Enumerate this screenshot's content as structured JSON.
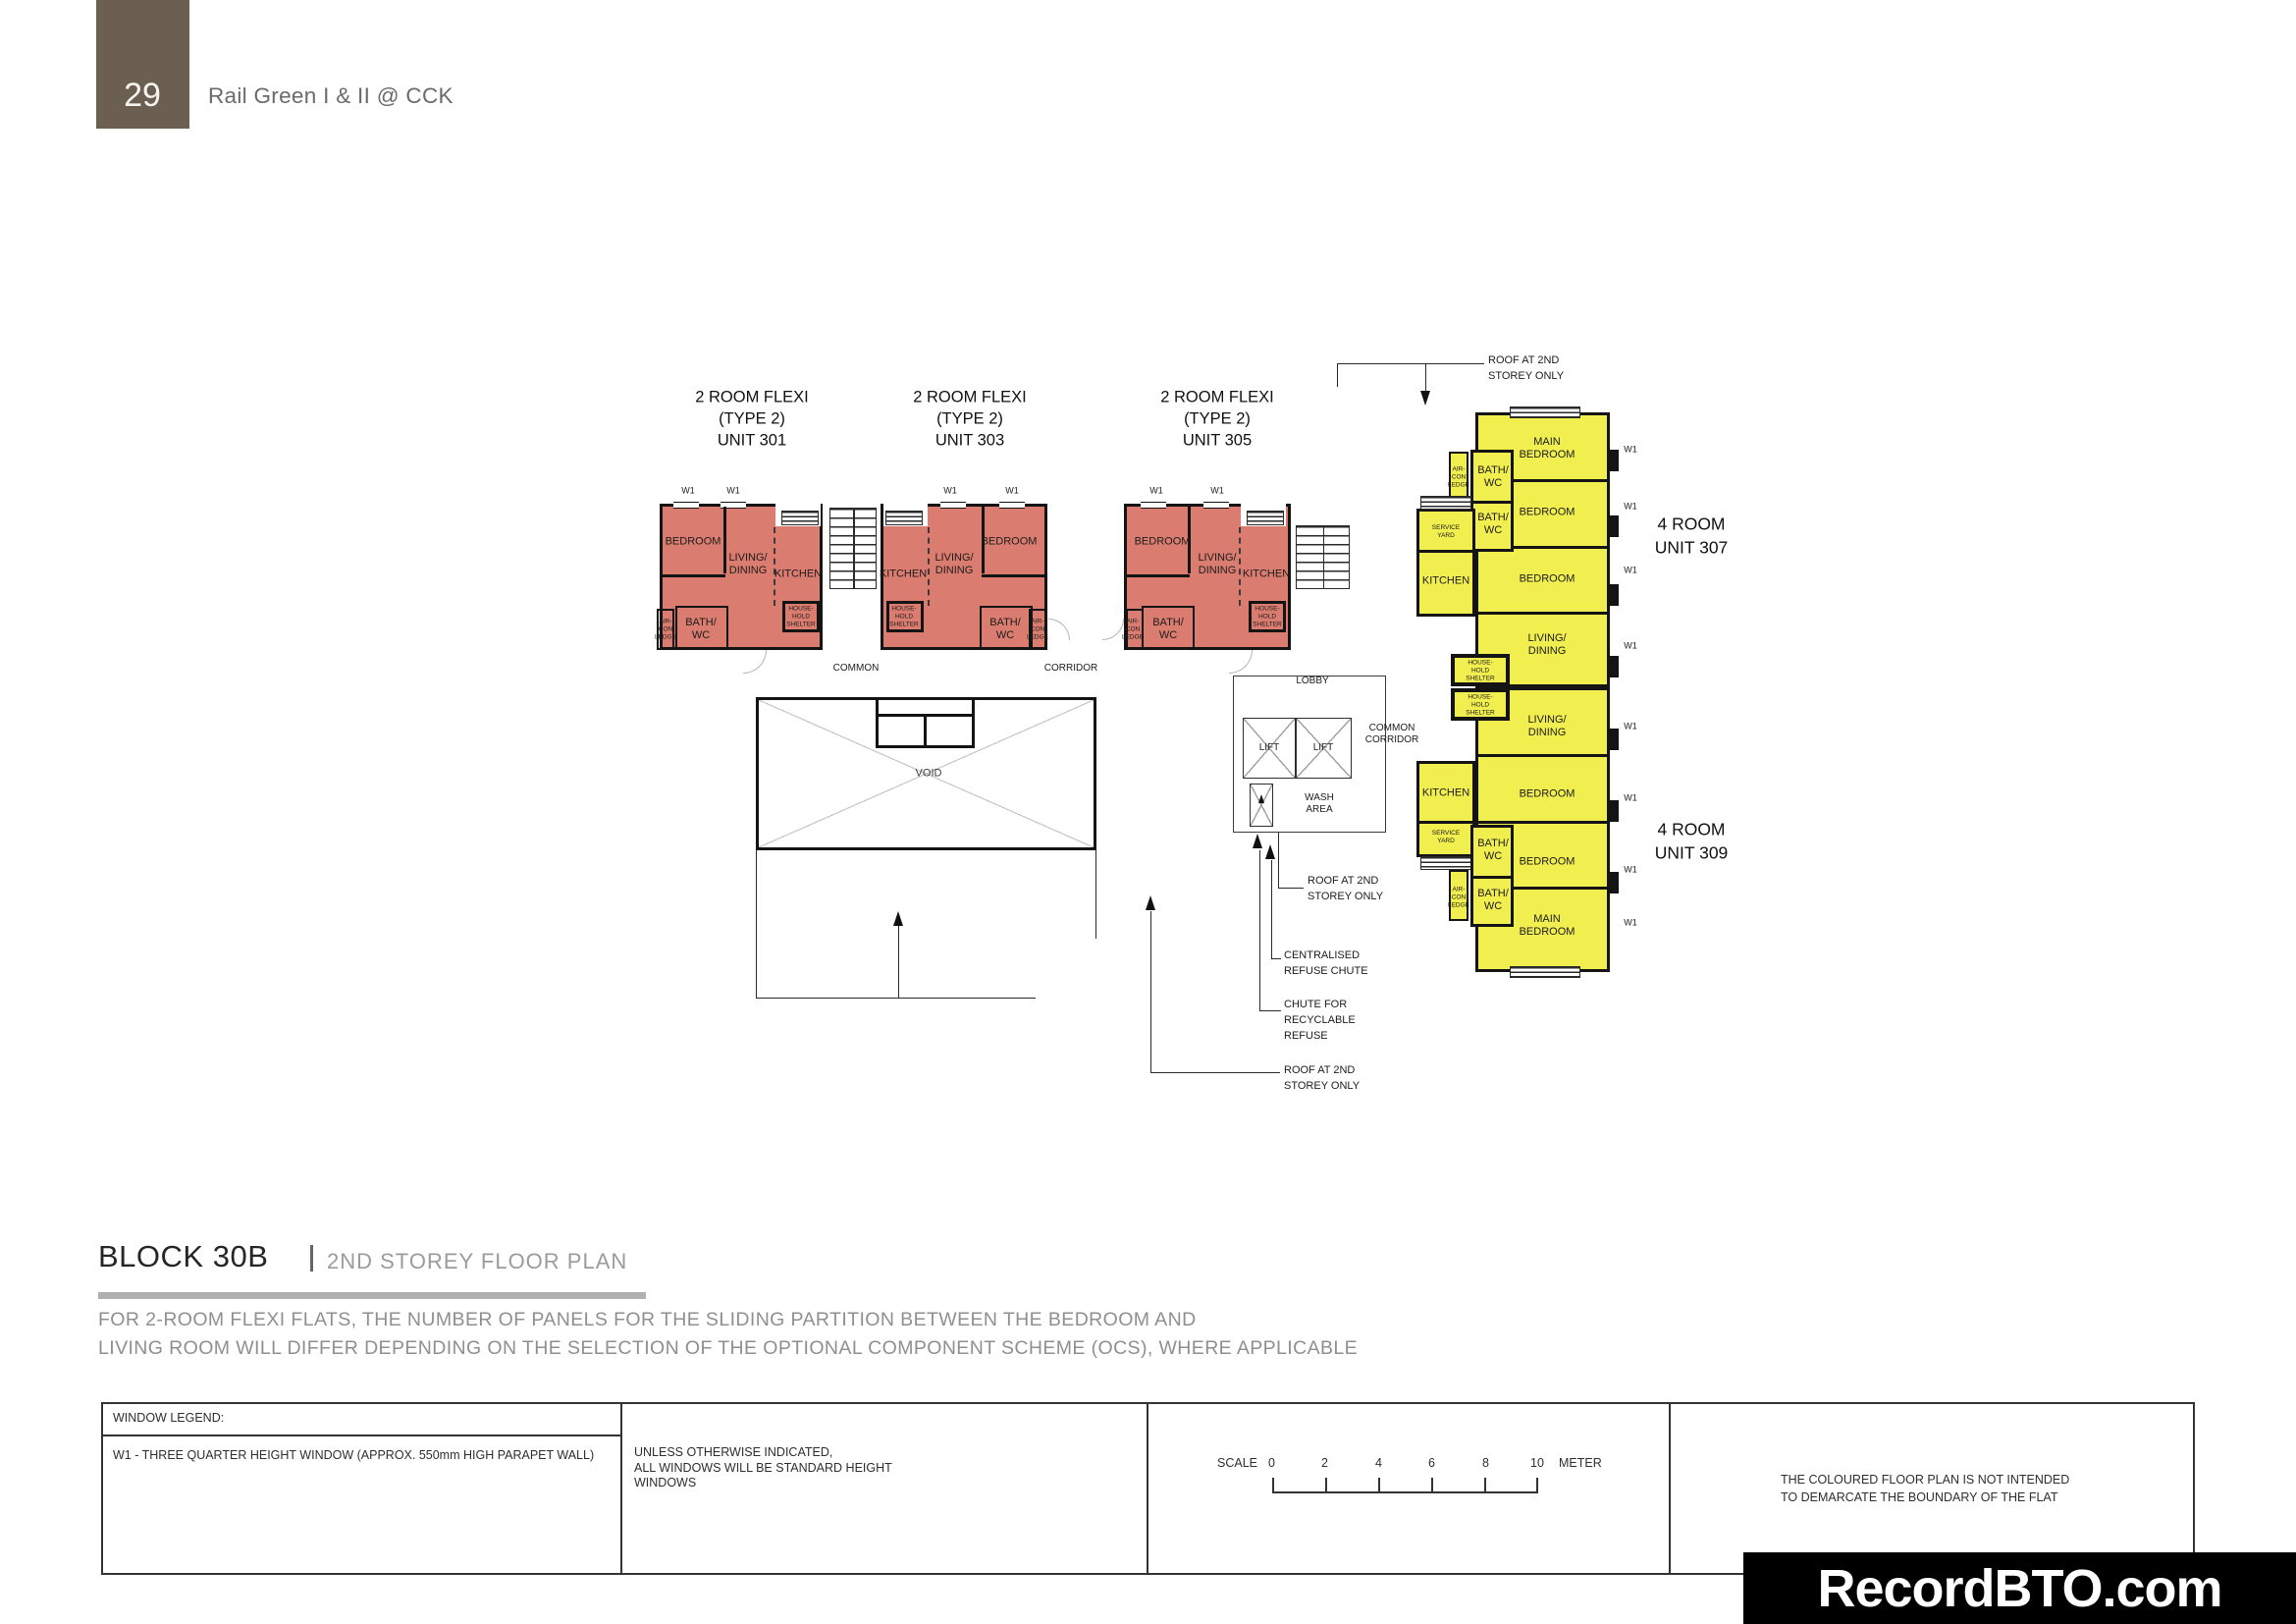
{
  "page": {
    "number": "29",
    "project": "Rail Green I & II @ CCK",
    "accent_color": "#6B5F52",
    "unit2_color": "#DA7C6F",
    "unit4_color": "#F1EE4F"
  },
  "plan": {
    "unit_titles": [
      "2 ROOM FLEXI\n(TYPE 2)\nUNIT 301",
      "2 ROOM FLEXI\n(TYPE 2)\nUNIT 303",
      "2 ROOM FLEXI\n(TYPE 2)\nUNIT 305",
      "4 ROOM\nUNIT 307",
      "4 ROOM\nUNIT 309"
    ],
    "labels": {
      "bedroom": "BEDROOM",
      "main_bedroom": "MAIN\nBEDROOM",
      "living_dining": "LIVING/\nDINING",
      "kitchen": "KITCHEN",
      "bath_wc": "BATH/\nWC",
      "household_shelter": "HOUSE-\nHOLD\nSHELTER",
      "aircon_ledge": "AIR-\nCON\nLEDGE",
      "service_yard": "SERVICE\nYARD",
      "common": "COMMON",
      "corridor": "CORRIDOR",
      "common_corridor": "COMMON\nCORRIDOR",
      "lobby": "LOBBY",
      "lift": "LIFT",
      "void": "VOID",
      "wash_area": "WASH\nAREA",
      "w1": "W1"
    },
    "annotations": {
      "roof_2nd": "ROOF AT 2ND\nSTOREY ONLY",
      "refuse_chute": "CENTRALISED\nREFUSE CHUTE",
      "recyclable_chute": "CHUTE FOR\nRECYCLABLE\nREFUSE"
    }
  },
  "footer": {
    "block_title": "BLOCK 30B",
    "plan_subtitle": "2ND STOREY FLOOR PLAN",
    "note": "FOR 2-ROOM FLEXI FLATS, THE NUMBER OF PANELS FOR THE SLIDING PARTITION BETWEEN THE BEDROOM AND\nLIVING ROOM WILL DIFFER DEPENDING ON THE SELECTION OF THE OPTIONAL COMPONENT SCHEME (OCS), WHERE APPLICABLE",
    "legend": {
      "header": "WINDOW LEGEND:",
      "w1_desc": "W1 - THREE QUARTER HEIGHT WINDOW (APPROX. 550mm HIGH PARAPET WALL)",
      "windows_note": "UNLESS OTHERWISE INDICATED,\nALL WINDOWS WILL BE STANDARD HEIGHT\nWINDOWS",
      "scale_label": "SCALE",
      "scale_ticks": [
        "0",
        "2",
        "4",
        "6",
        "8",
        "10"
      ],
      "scale_unit": "METER",
      "colour_note": "THE COLOURED FLOOR PLAN IS NOT INTENDED\nTO DEMARCATE THE BOUNDARY OF THE FLAT"
    },
    "watermark": "RecordBTO.com"
  }
}
